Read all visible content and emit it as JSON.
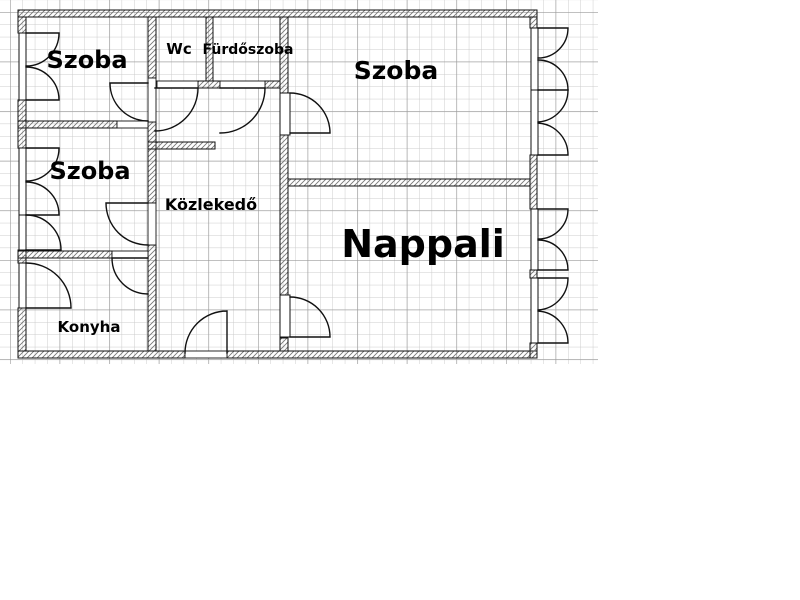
{
  "labels": {
    "szoba_top_left": "Szoba",
    "szoba_mid_left": "Szoba",
    "wc": "Wc",
    "furdoszoba": "Fürdőszoba",
    "szoba_top_right": "Szoba",
    "kozlekedo": "Közlekedő",
    "konyha": "Konyha",
    "nappali": "Nappali"
  },
  "colors": {
    "background": "#ffffff",
    "wall_line": "#111111",
    "wall_hatch": "#777777",
    "grid_minor": "#cccccc",
    "grid_major": "#9a9a9a",
    "label_text": "#000000"
  }
}
